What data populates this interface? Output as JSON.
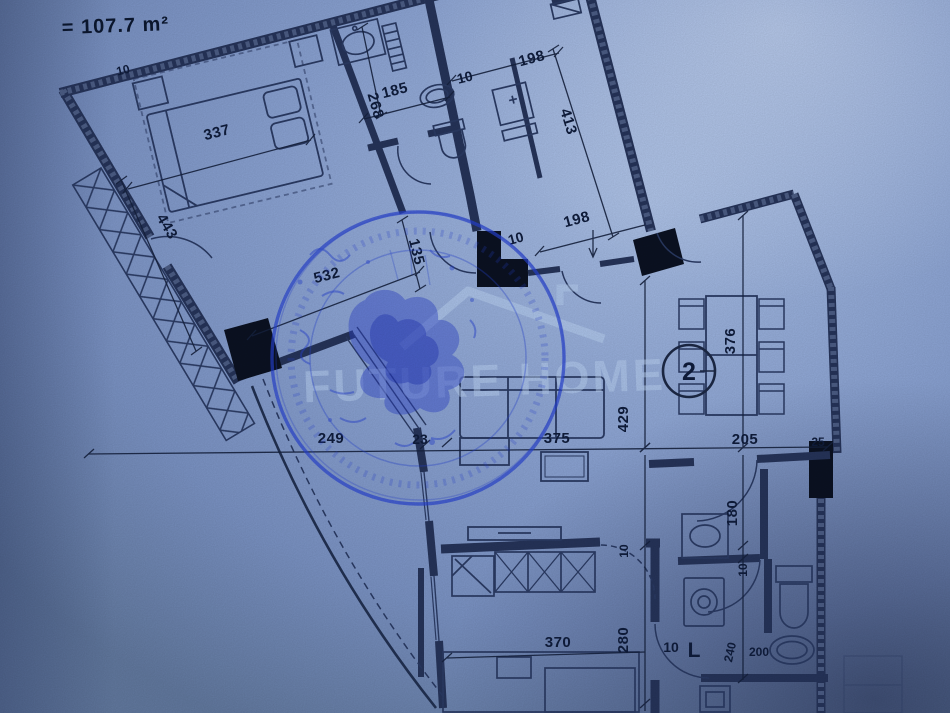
{
  "page": {
    "area_label": "= 107.7 m²"
  },
  "watermark": {
    "text": "FUTURE HOME"
  },
  "plan": {
    "room_number": "2"
  },
  "colors": {
    "paper": "#8aa2d2",
    "ink_line": "#1d2946",
    "stamp_ink": "#2742d2",
    "dim_text": "#101d3c"
  },
  "dims": {
    "bedroom_width": "337",
    "terrace_length": "443",
    "wing_bottom": "532",
    "bath_width": "185",
    "bath_depth": "268",
    "d10_bath": "10",
    "d10_wall": "10",
    "hall_top": "198",
    "hall_side": "413",
    "hall_width": "198",
    "entry_width": "135",
    "d10_entry": "10",
    "living_left": "249",
    "wall_23": "23",
    "living_width": "375",
    "dining_width": "205",
    "wall_25": "25",
    "living_height": "429",
    "dining_height": "376",
    "d10_kitchen": "10",
    "kitchen_height": "280",
    "kitchen_width": "370",
    "d10_bath2": "10",
    "bath2_letter": "L",
    "bath2_height": "180",
    "d10_bath2b": "10",
    "bath2_depth": "240",
    "bath2_width": "200"
  }
}
